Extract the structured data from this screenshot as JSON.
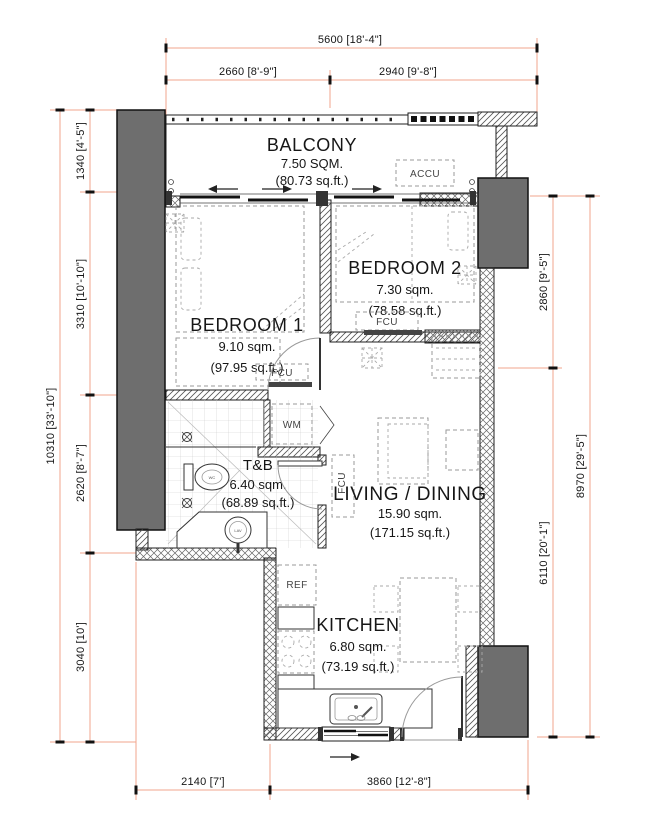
{
  "plan": {
    "rooms": {
      "balcony": {
        "name": "BALCONY",
        "area_sqm": "7.50 SQM.",
        "area_sqft": "(80.73 sq.ft.)"
      },
      "bedroom1": {
        "name": "BEDROOM 1",
        "area_sqm": "9.10 sqm.",
        "area_sqft": "(97.95 sq.ft.)"
      },
      "bedroom2": {
        "name": "BEDROOM 2",
        "area_sqm": "7.30 sqm.",
        "area_sqft": "(78.58 sq.ft.)"
      },
      "toilet_bath": {
        "name": "T&B",
        "area_sqm": "6.40 sqm.",
        "area_sqft": "(68.89 sq.ft.)"
      },
      "living_dining": {
        "name": "LIVING / DINING",
        "area_sqm": "15.90 sqm.",
        "area_sqft": "(171.15 sq.ft.)"
      },
      "kitchen": {
        "name": "KITCHEN",
        "area_sqm": "6.80 sqm.",
        "area_sqft": "(73.19 sq.ft.)"
      }
    },
    "equipment": {
      "accu": "ACCU",
      "wm": "WM",
      "ref": "REF",
      "fcu_bedroom1": "FCU",
      "fcu_bedroom2": "FCU",
      "fcu_living": "FCU",
      "wc": "WC",
      "lav": "LAV"
    },
    "dimensions": {
      "top_overall": "5600 [18'-4\"]",
      "top_left": "2660 [8'-9\"]",
      "top_right": "2940 [9'-8\"]",
      "left_overall": "10310 [33'-10\"]",
      "left_1": "1340 [4'-5\"]",
      "left_2": "3310 [10'-10\"]",
      "left_3": "2620 [8'-7\"]",
      "left_4": "3040 [10']",
      "right_overall": "8970 [29'-5\"]",
      "right_1": "2860 [9'-5\"]",
      "right_2": "6110 [20'-1\"]",
      "bottom_left": "2140 [7']",
      "bottom_right": "3860 [12'-8\"]"
    },
    "colors": {
      "dimension": "#f2a58c",
      "column": "#6e6e6e",
      "wall": "#1f1f1f"
    }
  }
}
